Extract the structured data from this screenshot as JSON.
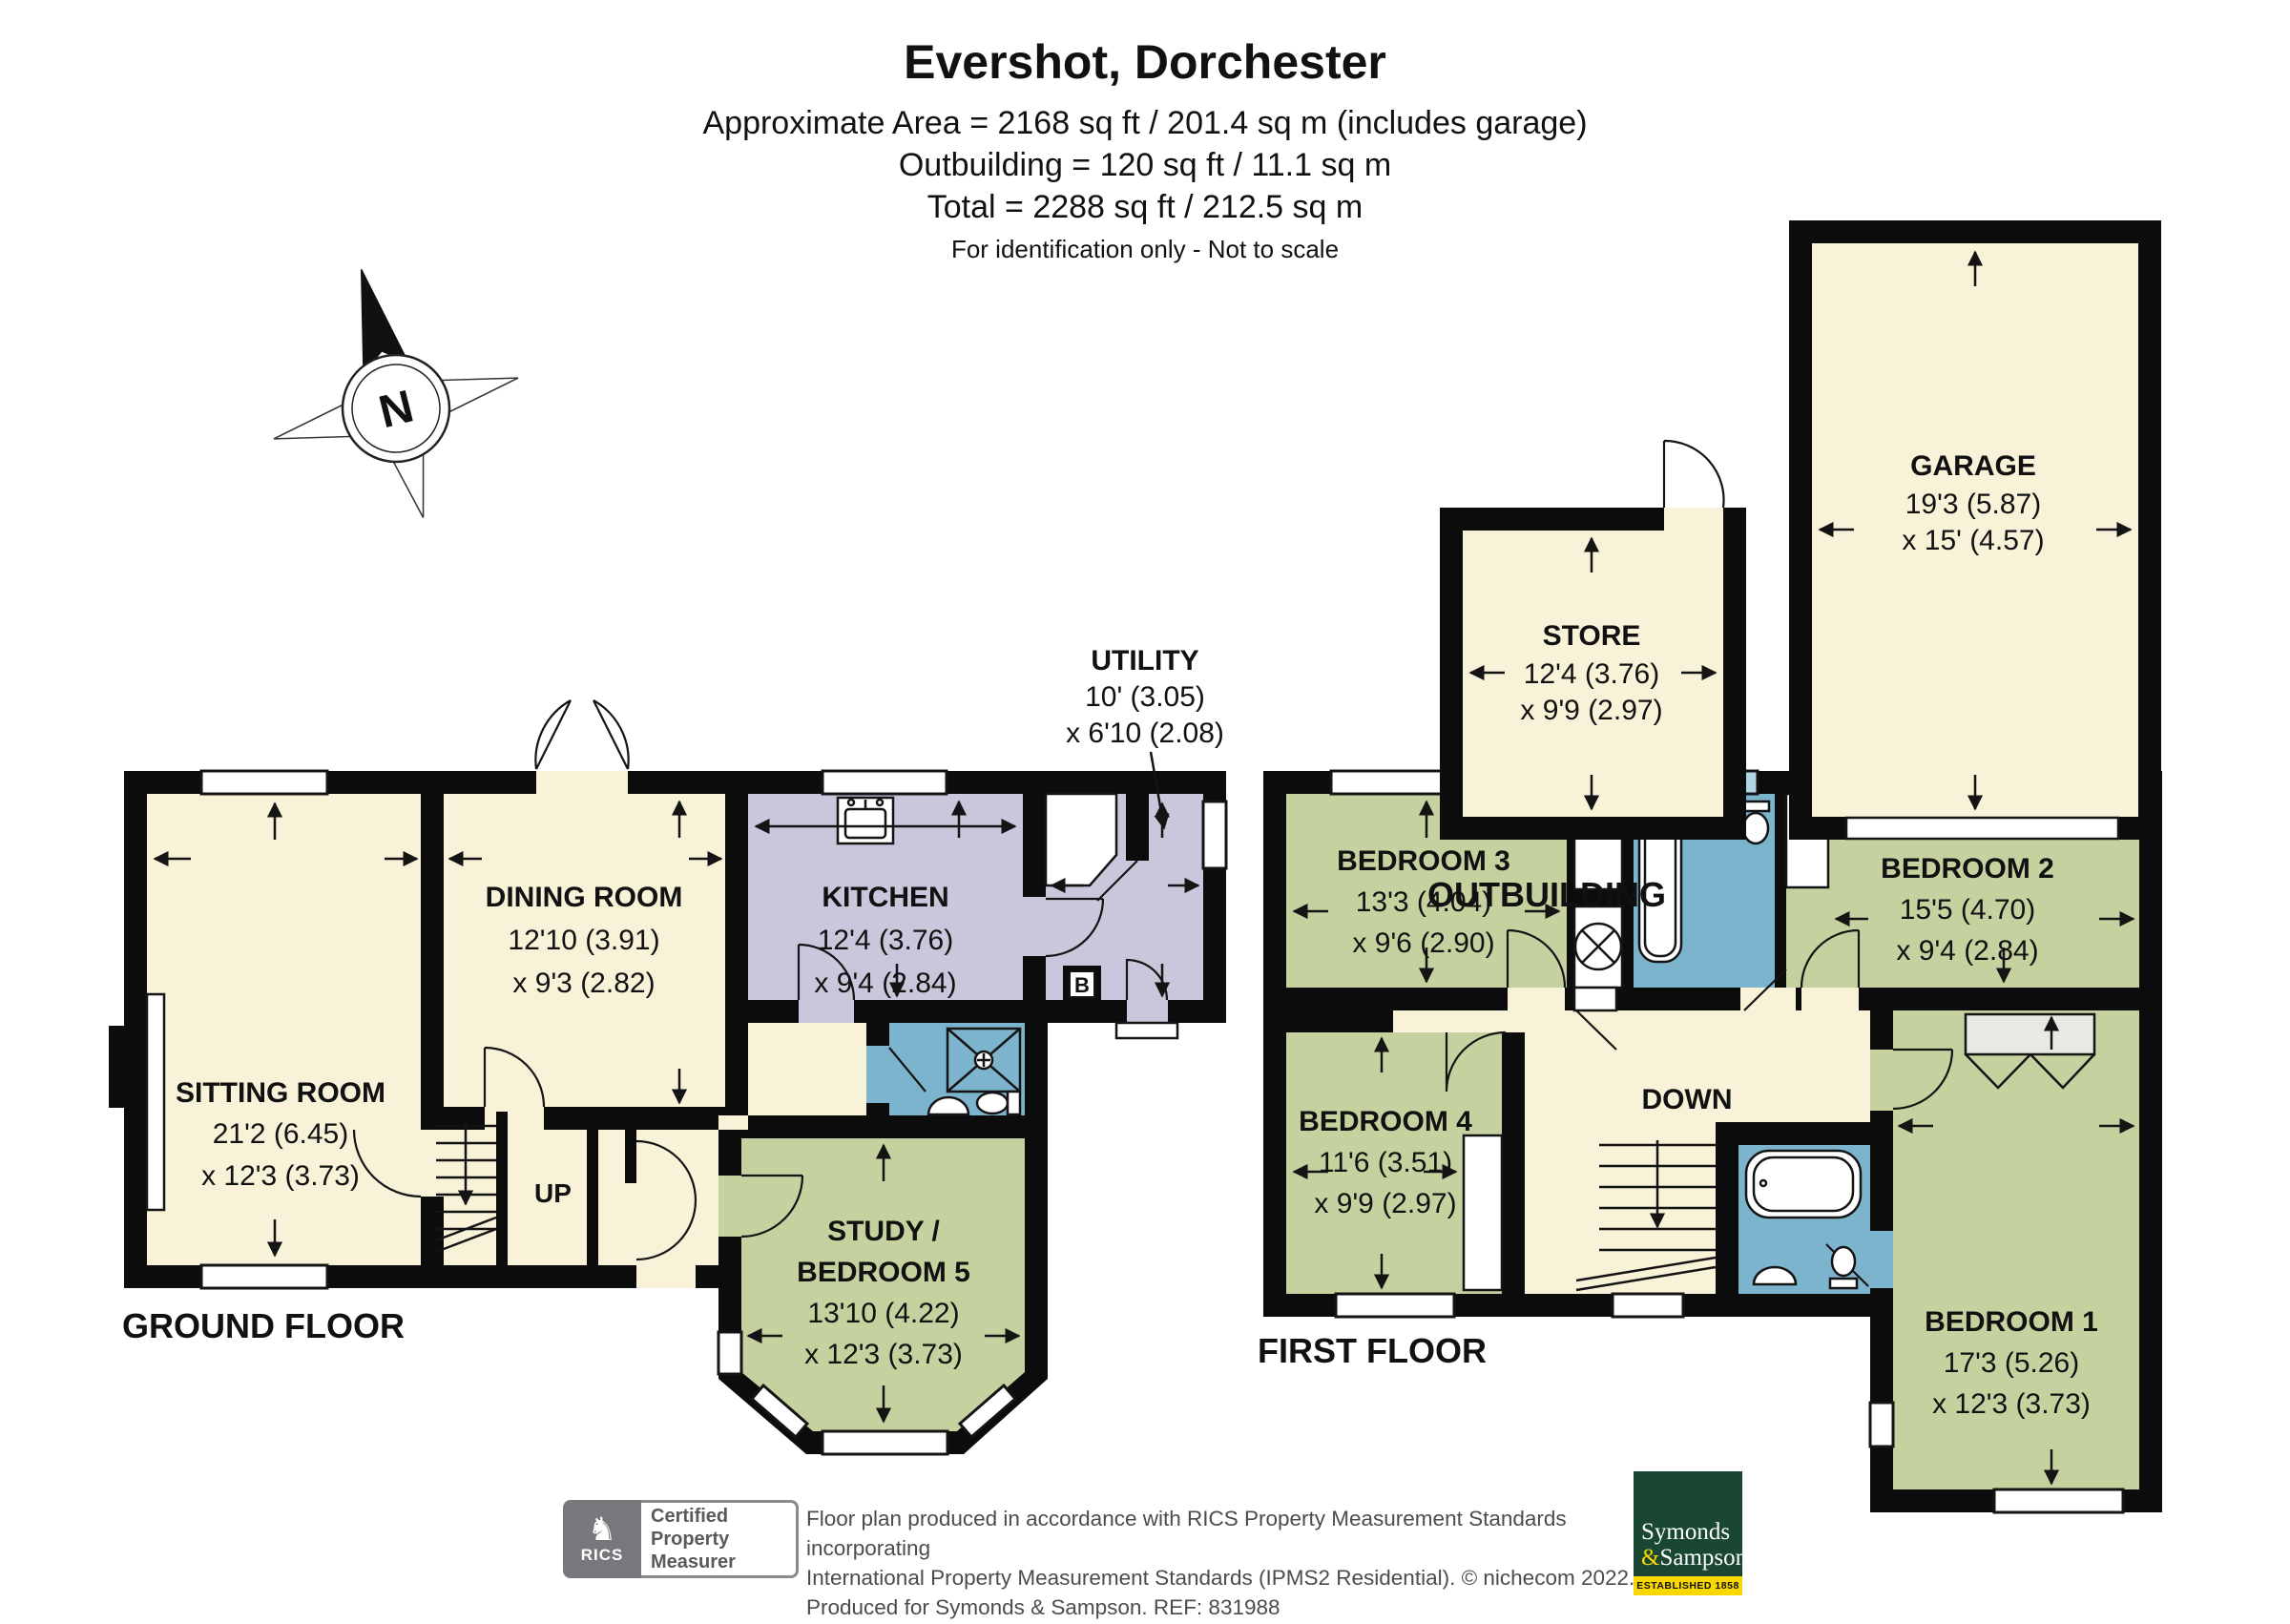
{
  "header": {
    "title": "Evershot, Dorchester",
    "area_line1": "Approximate Area = 2168 sq ft / 201.4 sq m (includes garage)",
    "area_line2": "Outbuilding = 120 sq ft / 11.1 sq m",
    "area_line3": "Total = 2288 sq ft / 212.5 sq m",
    "disclaimer": "For identification only - Not to scale"
  },
  "compass": {
    "north": "N"
  },
  "floor_labels": {
    "ground": "GROUND FLOOR",
    "first": "FIRST FLOOR",
    "outbuilding": "OUTBUILDING"
  },
  "rooms": {
    "sitting": {
      "name": "SITTING ROOM",
      "dim1": "21'2 (6.45)",
      "dim2": "x 12'3 (3.73)"
    },
    "dining": {
      "name": "DINING ROOM",
      "dim1": "12'10 (3.91)",
      "dim2": "x 9'3 (2.82)"
    },
    "kitchen": {
      "name": "KITCHEN",
      "dim1": "12'4 (3.76)",
      "dim2": "x 9'4 (2.84)"
    },
    "utility": {
      "name": "UTILITY",
      "dim1": "10' (3.05)",
      "dim2": "x 6'10 (2.08)"
    },
    "study": {
      "name1": "STUDY /",
      "name2": "BEDROOM 5",
      "dim1": "13'10 (4.22)",
      "dim2": "x 12'3 (3.73)"
    },
    "bedroom1": {
      "name": "BEDROOM 1",
      "dim1": "17'3 (5.26)",
      "dim2": "x 12'3 (3.73)"
    },
    "bedroom2": {
      "name": "BEDROOM 2",
      "dim1": "15'5 (4.70)",
      "dim2": "x 9'4 (2.84)"
    },
    "bedroom3": {
      "name": "BEDROOM 3",
      "dim1": "13'3 (4.04)",
      "dim2": "x 9'6 (2.90)"
    },
    "bedroom4": {
      "name": "BEDROOM 4",
      "dim1": "11'6 (3.51)",
      "dim2": "x 9'9 (2.97)"
    },
    "store": {
      "name": "STORE",
      "dim1": "12'4 (3.76)",
      "dim2": "x 9'9 (2.97)"
    },
    "garage": {
      "name": "GARAGE",
      "dim1": "19'3 (5.87)",
      "dim2": "x 15' (4.57)"
    }
  },
  "stairs": {
    "up": "UP",
    "down": "DOWN"
  },
  "boiler": "B",
  "footer": {
    "rics": {
      "lion": "♞",
      "brand": "RICS",
      "line1": "Certified",
      "line2": "Property",
      "line3": "Measurer"
    },
    "disclaimer_line1": "Floor plan produced in accordance with RICS Property Measurement Standards incorporating",
    "disclaimer_line2": "International Property Measurement Standards (IPMS2 Residential).   © nichecom 2022.",
    "disclaimer_line3": "Produced for Symonds & Sampson.   REF: 831988",
    "agent": {
      "name1": "Symonds",
      "amp": "&",
      "name2": "Sampson",
      "established": "ESTABLISHED 1858"
    }
  },
  "colors": {
    "wall": "#0c0c0c",
    "line": "#141414",
    "cream": "#f7f2d8",
    "green": "#c5d2a0",
    "lavender": "#c8c7dc",
    "bath": "#7cb4cd",
    "bathwin": "#b3d4e2",
    "ward": "#e9e9e3",
    "ssgreen": "#1a4733",
    "ssyellow": "#f8d800"
  }
}
